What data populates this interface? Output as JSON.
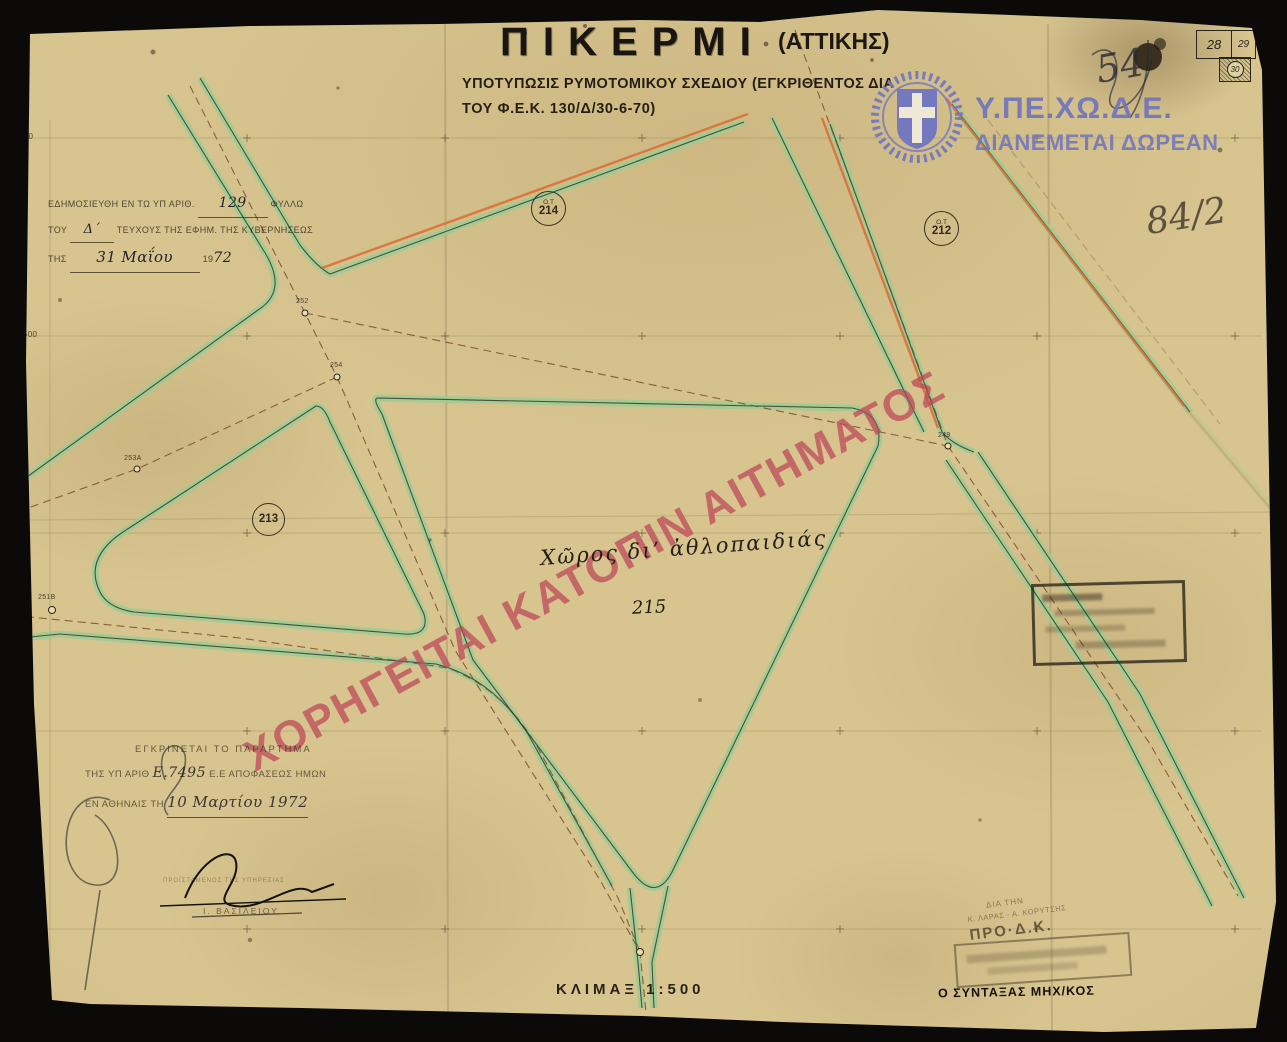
{
  "document": {
    "title": "ΠΙΚΕΡΜΙ",
    "title_suffix": "(ΑΤΤΙΚΗΣ)",
    "subtitle_line1": "ΥΠΟΤΥΠΩΣΙΣ ΡΥΜΟΤΟΜΙΚΟΥ ΣΧΕΔΙΟΥ (ΕΓΚΡΙΘΕΝΤΟΣ ΔΙΑ",
    "subtitle_line2": "ΤΟΥ Φ.Ε.Κ. 130/Δ/30-6-70)",
    "scale_label": "ΚΛΙΜΑΞ 1:500"
  },
  "agency": {
    "name": "Υ.ΠΕ.ΧΩ.Δ.Ε.",
    "tagline": "ΔΙΑΝΕΜΕΤΑΙ ΔΩΡΕΑΝ",
    "emblem": "greek-coat-of-arms",
    "accent_color": "#7478be"
  },
  "watermark": {
    "text": "ΧΟΡΗΓΕΙΤΑΙ ΚΑΤΟΠΙΝ ΑΙΤΗΜΑΤΟΣ",
    "color": "#bb4758"
  },
  "publication_note": {
    "line1_prefix": "ΕΔΗΜΟΣΙΕΥΘΗ ΕΝ ΤΩ ΥΠ ΑΡΙΘ.",
    "line1_value": "129",
    "line1_suffix": "ΦΥΛΛΩ",
    "line2_prefix": "ΤΟΥ",
    "line2_value": "Δ΄",
    "line2_suffix": "ΤΕΥΧΟΥΣ ΤΗΣ ΕΦΗΜ. ΤΗΣ ΚΥΒΕΡΝΗΣΕΩΣ",
    "line3_prefix": "ΤΗΣ",
    "line3_value": "31 Μαΐου",
    "line3_year_prefix": "19",
    "line3_year": "72"
  },
  "approval_note": {
    "line1": "ΕΓΚΡΙΝΕΤΑΙ ΤΟ ΠΑΡΑΡΤΗΜΑ",
    "line2_prefix": "ΤΗΣ ΥΠ ΑΡΙΘ",
    "line2_value": "Ε.7495",
    "line2_suffix": "Ε.Ε ΑΠΟΦΑΣΕΩΣ ΗΜΩΝ",
    "line3_prefix": "ΕΝ ΑΘΗΝΑΙΣ ΤΗ",
    "line3_value": "10 Μαρτίου 1972"
  },
  "signature": {
    "stamp_text": "ΠΡΟΪΣΤΑΜΕΝΟΣ ΤΗΣ ΥΠΗΡΕΣΙΑΣ",
    "name": "Ι. ΒΑΣΙΛΕΙΟΥ"
  },
  "stamps": {
    "pro_line1": "ΔΙΑ ΤΗΝ",
    "pro_line2": "Κ. ΛΑΡΑΣ - Α. ΚΟΡΥΤΣΗΣ",
    "pro_line3": "ΠΡΟ·Δ.Κ.",
    "drafter_label": "Ο ΣΥΝΤΑΞΑΣ ΜΗΧ/ΚΟΣ"
  },
  "annotations": {
    "plan_number": "84/2",
    "corner_note": "54",
    "area_label": "Χῶρος δι’ ἀθλοπαιδιάς"
  },
  "sheet_index": {
    "left": "28",
    "right": "29",
    "current": "30"
  },
  "blocks": {
    "b214": {
      "prefix": "Ο.Τ",
      "number": "214"
    },
    "b212": {
      "prefix": "Ο.Τ",
      "number": "212"
    },
    "b213": {
      "number": "213"
    },
    "b215": {
      "number": "215"
    }
  },
  "survey_points": {
    "p252": "252",
    "p254": "254",
    "p253": "253Α",
    "p251": "251Β",
    "p249": "249"
  },
  "grid_labels": {
    "g1": "-25.850",
    "g2": "-25.500",
    "g3": "25.950",
    "g4": "-26.000",
    "g5": "-26.050",
    "v1": "-3350"
  },
  "map_colors": {
    "planting_strip_green": "#9ccd94",
    "street_line_orange": "#dd6f38",
    "centerline_brown": "#7d4c30",
    "paper": "#d7c48f"
  }
}
